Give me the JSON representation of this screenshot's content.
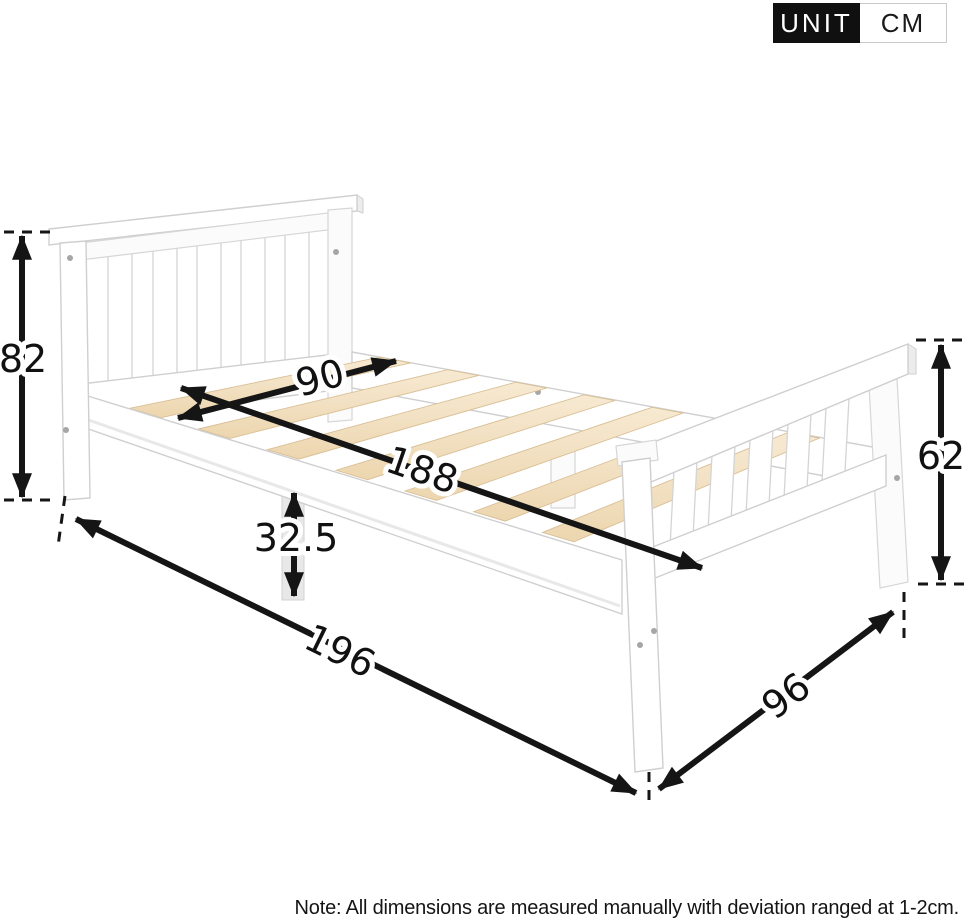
{
  "unit_badge": {
    "label": "UNIT",
    "value": "CM"
  },
  "dimensions": {
    "headboard_height": "82",
    "slat_clear_width": "90",
    "slat_area_length": "188",
    "under_frame_height": "32.5",
    "overall_length": "196",
    "overall_width": "96",
    "footboard_height": "62"
  },
  "note": "Note: All dimensions are measured manually with deviation ranged at 1-2cm.",
  "colors": {
    "arrow": "#151515",
    "badge_black": "#101010",
    "frame_white": "#ffffff",
    "frame_outline": "#cfcfcf",
    "slat_wood": "#f2e0c2"
  }
}
